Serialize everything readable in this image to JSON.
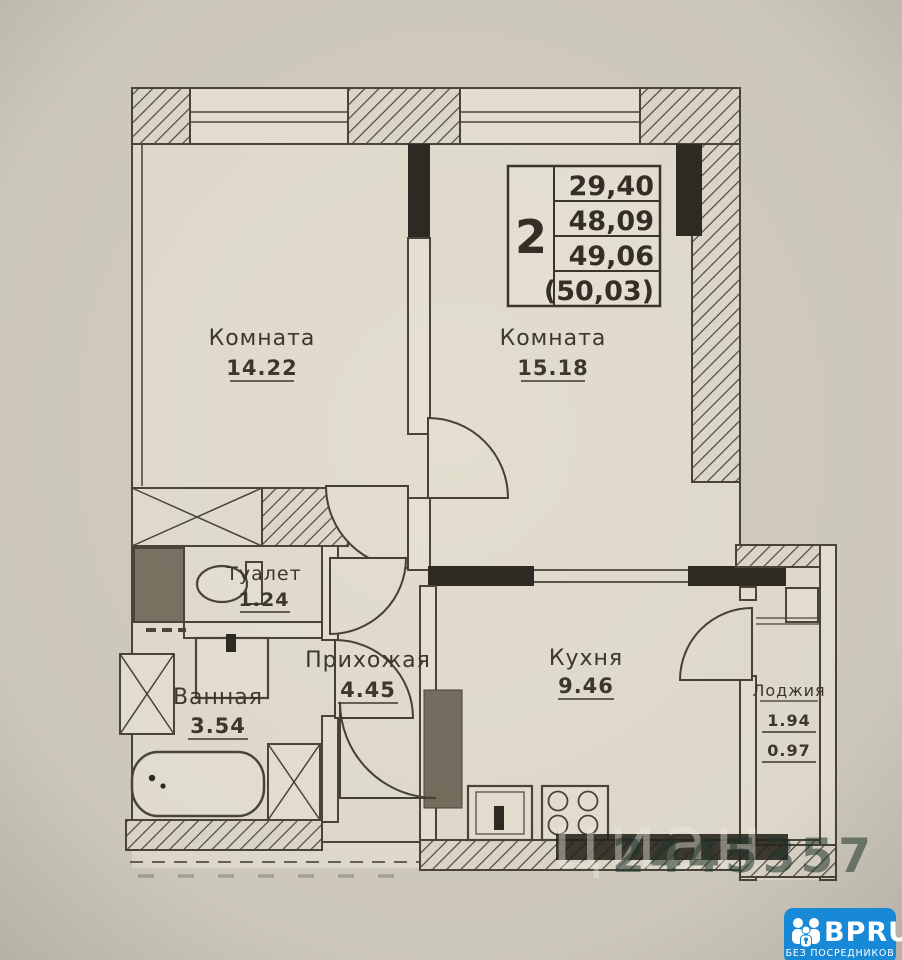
{
  "plan": {
    "stamp": {
      "room_count": "2",
      "values": [
        "29,40",
        "48,09",
        "49,06",
        "(50,03)"
      ]
    },
    "rooms": {
      "room1": {
        "name": "Комната",
        "area": "14.22"
      },
      "room2": {
        "name": "Комната",
        "area": "15.18"
      },
      "kitchen": {
        "name": "Кухня",
        "area": "9.46"
      },
      "hallway": {
        "name": "Прихожая",
        "area": "4.45"
      },
      "bathroom": {
        "name": "Ванная",
        "area": "3.54"
      },
      "toilet": {
        "name": "Туалет",
        "area": "1.24"
      },
      "loggia": {
        "name": "Лоджия",
        "area": "1.94",
        "reduced_area": "0.97"
      }
    }
  },
  "watermark": {
    "brand": "циан",
    "id": "2445357"
  },
  "logo": {
    "text": "BPRU",
    "tagline": "БЕЗ ПОСРЕДНИКОВ"
  },
  "colors": {
    "logo_blue": "#1789d6",
    "paper": "#d2cdc0",
    "ink": "#464036"
  }
}
